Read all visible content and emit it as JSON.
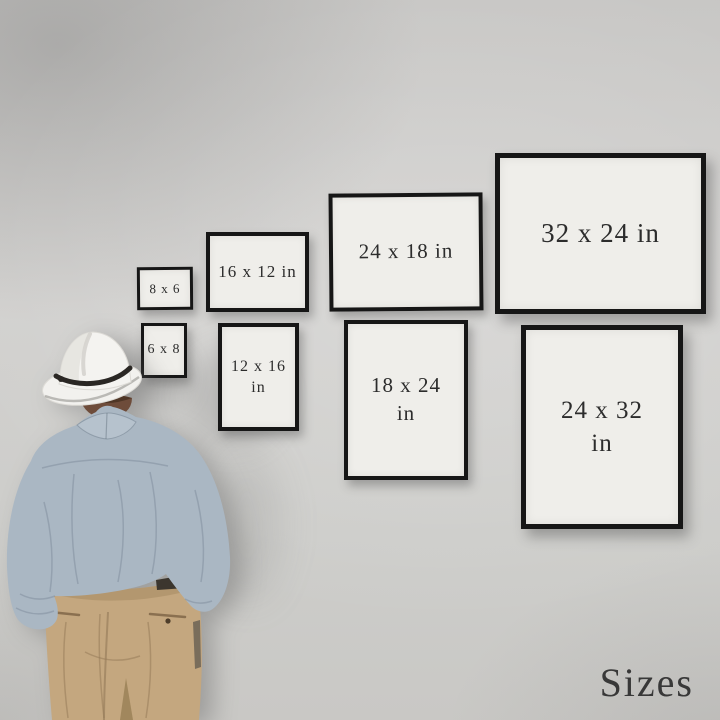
{
  "scene": {
    "title": "Sizes",
    "description": "Man in a white fedora, light blue shirt and khaki trousers seen from behind, viewing eight black gallery frames labelled with print sizes"
  },
  "colors": {
    "wall": "#cecdca",
    "frame_border": "#161616",
    "frame_paper": "#efeeea",
    "label_text": "#2c2c2c",
    "title_text": "#383838",
    "hat": "#f3f2ef",
    "hat_band": "#2a2724",
    "hair": "#6e4c3a",
    "skin": "#9b7a62",
    "shirt": "#aab7c3",
    "trousers": "#c4a77f",
    "belt": "#3c362e"
  },
  "frames": [
    {
      "id": "8x6",
      "line1": "8 x 6",
      "line2": ""
    },
    {
      "id": "6x8",
      "line1": "6 x 8",
      "line2": ""
    },
    {
      "id": "16x12",
      "line1": "16 x 12 in",
      "line2": ""
    },
    {
      "id": "12x16",
      "line1": "12 x 16",
      "line2": "in"
    },
    {
      "id": "24x18",
      "line1": "24 x 18 in",
      "line2": ""
    },
    {
      "id": "18x24",
      "line1": "18 x 24",
      "line2": "in"
    },
    {
      "id": "32x24",
      "line1": "32 x 24 in",
      "line2": ""
    },
    {
      "id": "24x32",
      "line1": "24 x 32",
      "line2": "in"
    }
  ]
}
